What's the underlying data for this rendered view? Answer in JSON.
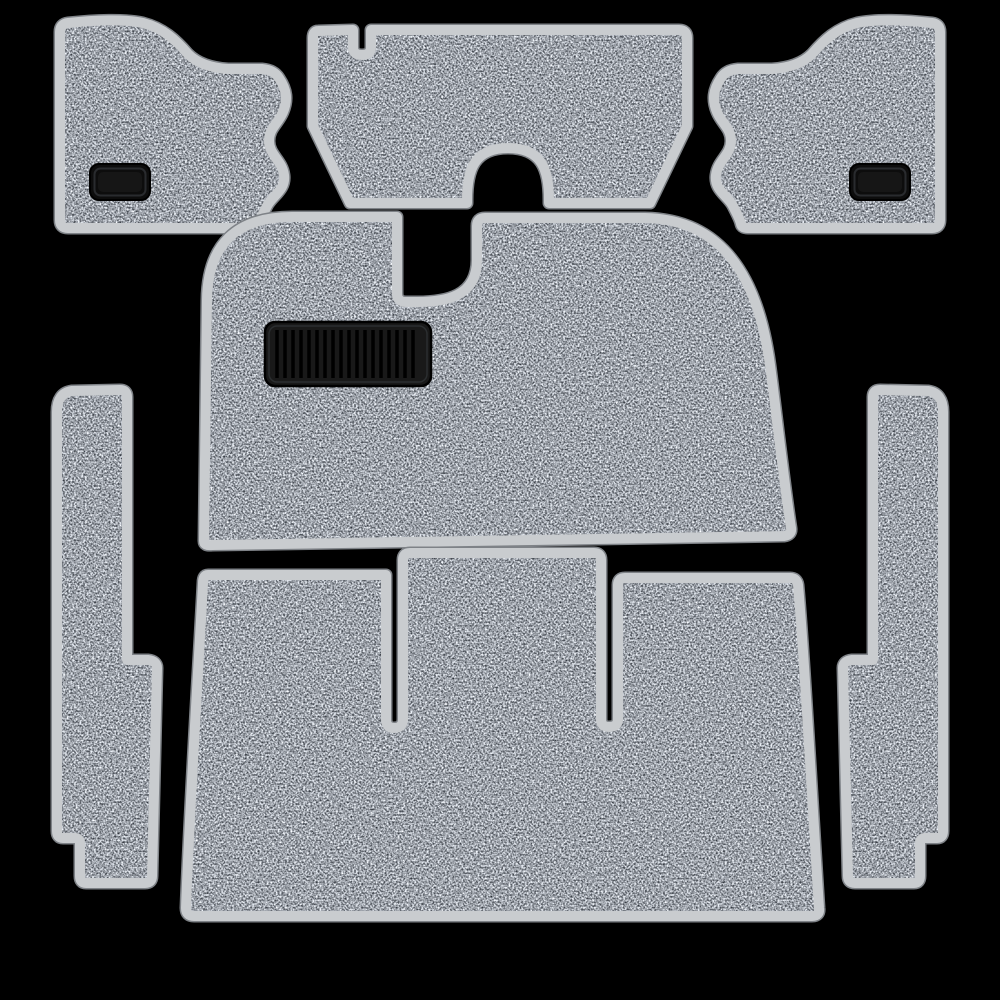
{
  "image": {
    "type": "product-photo",
    "subject": "7-piece salt-and-pepper gray automotive interior carpet kit",
    "background_color": "#000000"
  },
  "colors": {
    "carpet_base": "#9aa0a5",
    "carpet_dark_fleck": "#41464c",
    "carpet_light_fleck": "#dfe1e3",
    "binding": "#c9cccf",
    "binding_rim": "#7e8287",
    "heel_pad": "#0d0d0d",
    "shadow": "#000000"
  },
  "pieces": [
    {
      "id": "left-kick-panel",
      "label": "Left kick panel with vinyl heel pad"
    },
    {
      "id": "rear-firewall-panel",
      "label": "Rear firewall panel with tunnel arch cutout"
    },
    {
      "id": "right-kick-panel",
      "label": "Right kick panel with vinyl heel pad"
    },
    {
      "id": "front-floor-panel",
      "label": "Front floor panel with ribbed heel pad"
    },
    {
      "id": "left-rocker-strip",
      "label": "Left rocker sill strip"
    },
    {
      "id": "right-rocker-strip",
      "label": "Right rocker sill strip"
    },
    {
      "id": "rear-floor-panel",
      "label": "Rear floor panel with seat-mount slots"
    }
  ]
}
